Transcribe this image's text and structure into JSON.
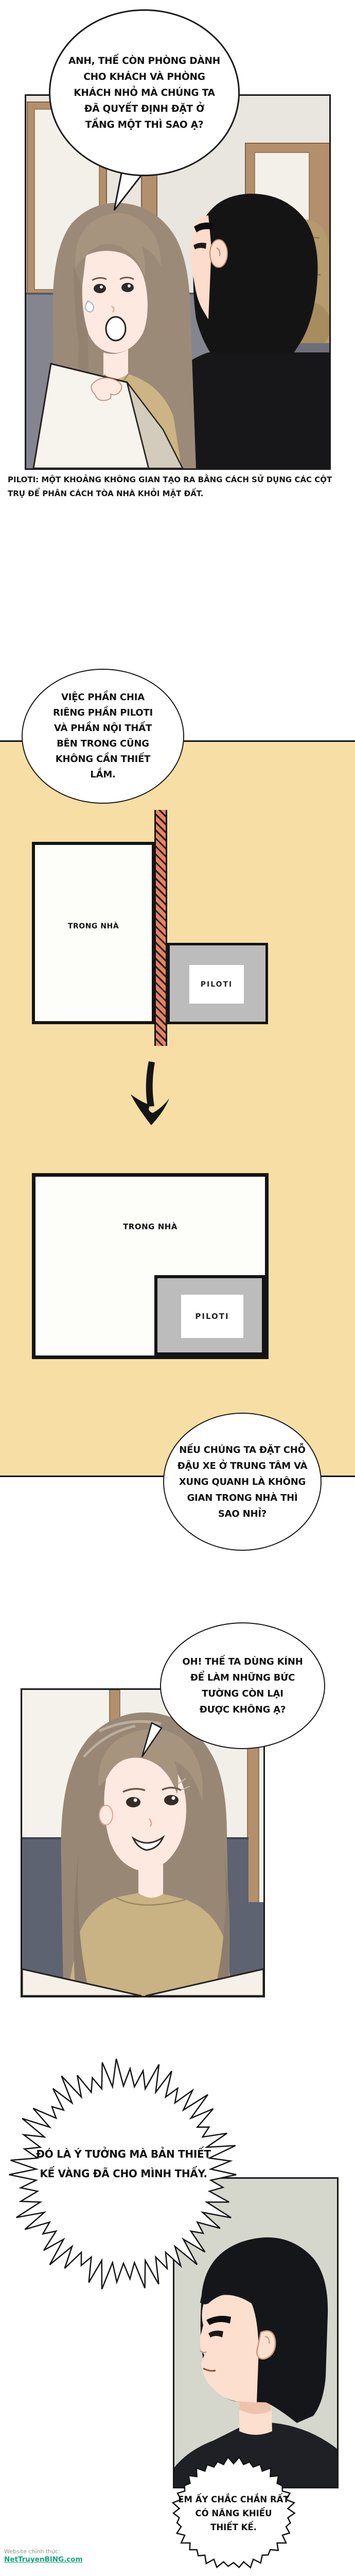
{
  "comic": {
    "dialogue": {
      "bubble1": [
        "ANH, THẾ CÒN PHÒNG DÀNH",
        "CHO KHÁCH VÀ PHÒNG",
        "KHÁCH NHỎ MÀ CHÚNG TA",
        "ĐÃ QUYẾT ĐỊNH ĐẶT Ở",
        "TẦNG MỘT THÌ SAO Ạ?"
      ],
      "bubble2": [
        "VIỆC PHẦN CHIA",
        "RIÊNG PHẦN PILOTI",
        "VÀ PHẦN NỘI THẤT",
        "BÊN TRONG CŨNG",
        "KHÔNG CẦN THIẾT",
        "LẮM."
      ],
      "bubble3": [
        "NẾU CHÚNG TA ĐẶT CHỖ",
        "ĐẬU XE Ở TRUNG TÂM VÀ",
        "XUNG QUANH LÀ KHÔNG",
        "GIAN TRONG NHÀ THÌ",
        "SAO NHỈ?"
      ],
      "bubble4": [
        "OH! THẾ TA DÙNG KÍNH",
        "ĐỂ LÀM NHỮNG BỨC",
        "TƯỜNG CÒN LẠI",
        "ĐƯỢC KHÔNG Ạ?"
      ],
      "burst": [
        "ĐÓ LÀ Ý TƯỞNG MÀ BẢN THIẾT",
        "KẾ VÀNG ĐÃ CHO MÌNH THẤY."
      ],
      "bubble5": [
        "EM ẤY CHẮC CHẮN RẤT",
        "CÓ NĂNG KHIẾU",
        "THIẾT KẾ."
      ]
    },
    "caption": [
      "PILOTI: MỘT KHOẢNG KHÔNG GIAN TẠO RA BẰNG CÁCH SỬ DỤNG CÁC CỘT",
      "TRỤ ĐỂ PHÂN CÁCH TÒA NHÀ KHỎI MẶT ĐẤT."
    ],
    "diagrams": {
      "before": {
        "room": "TRONG NHÀ",
        "piloti": "PILOTI"
      },
      "after": {
        "room": "TRONG NHÀ",
        "piloti": "PILOTI"
      }
    },
    "watermark": {
      "prefix": "Website chính thức:",
      "site": "NetTruyenBING.com"
    },
    "colors": {
      "section_bg": "#f7dea4",
      "hatch_wall_orange": "#e8835c",
      "piloti_gray": "#bcbcbc",
      "watermark_green": "#0da57a",
      "couch_gray": "#84858f",
      "couch_dark": "#5d6370",
      "wood_frame": "#b3906b",
      "panel3_bg": "#d5d6cc"
    }
  }
}
